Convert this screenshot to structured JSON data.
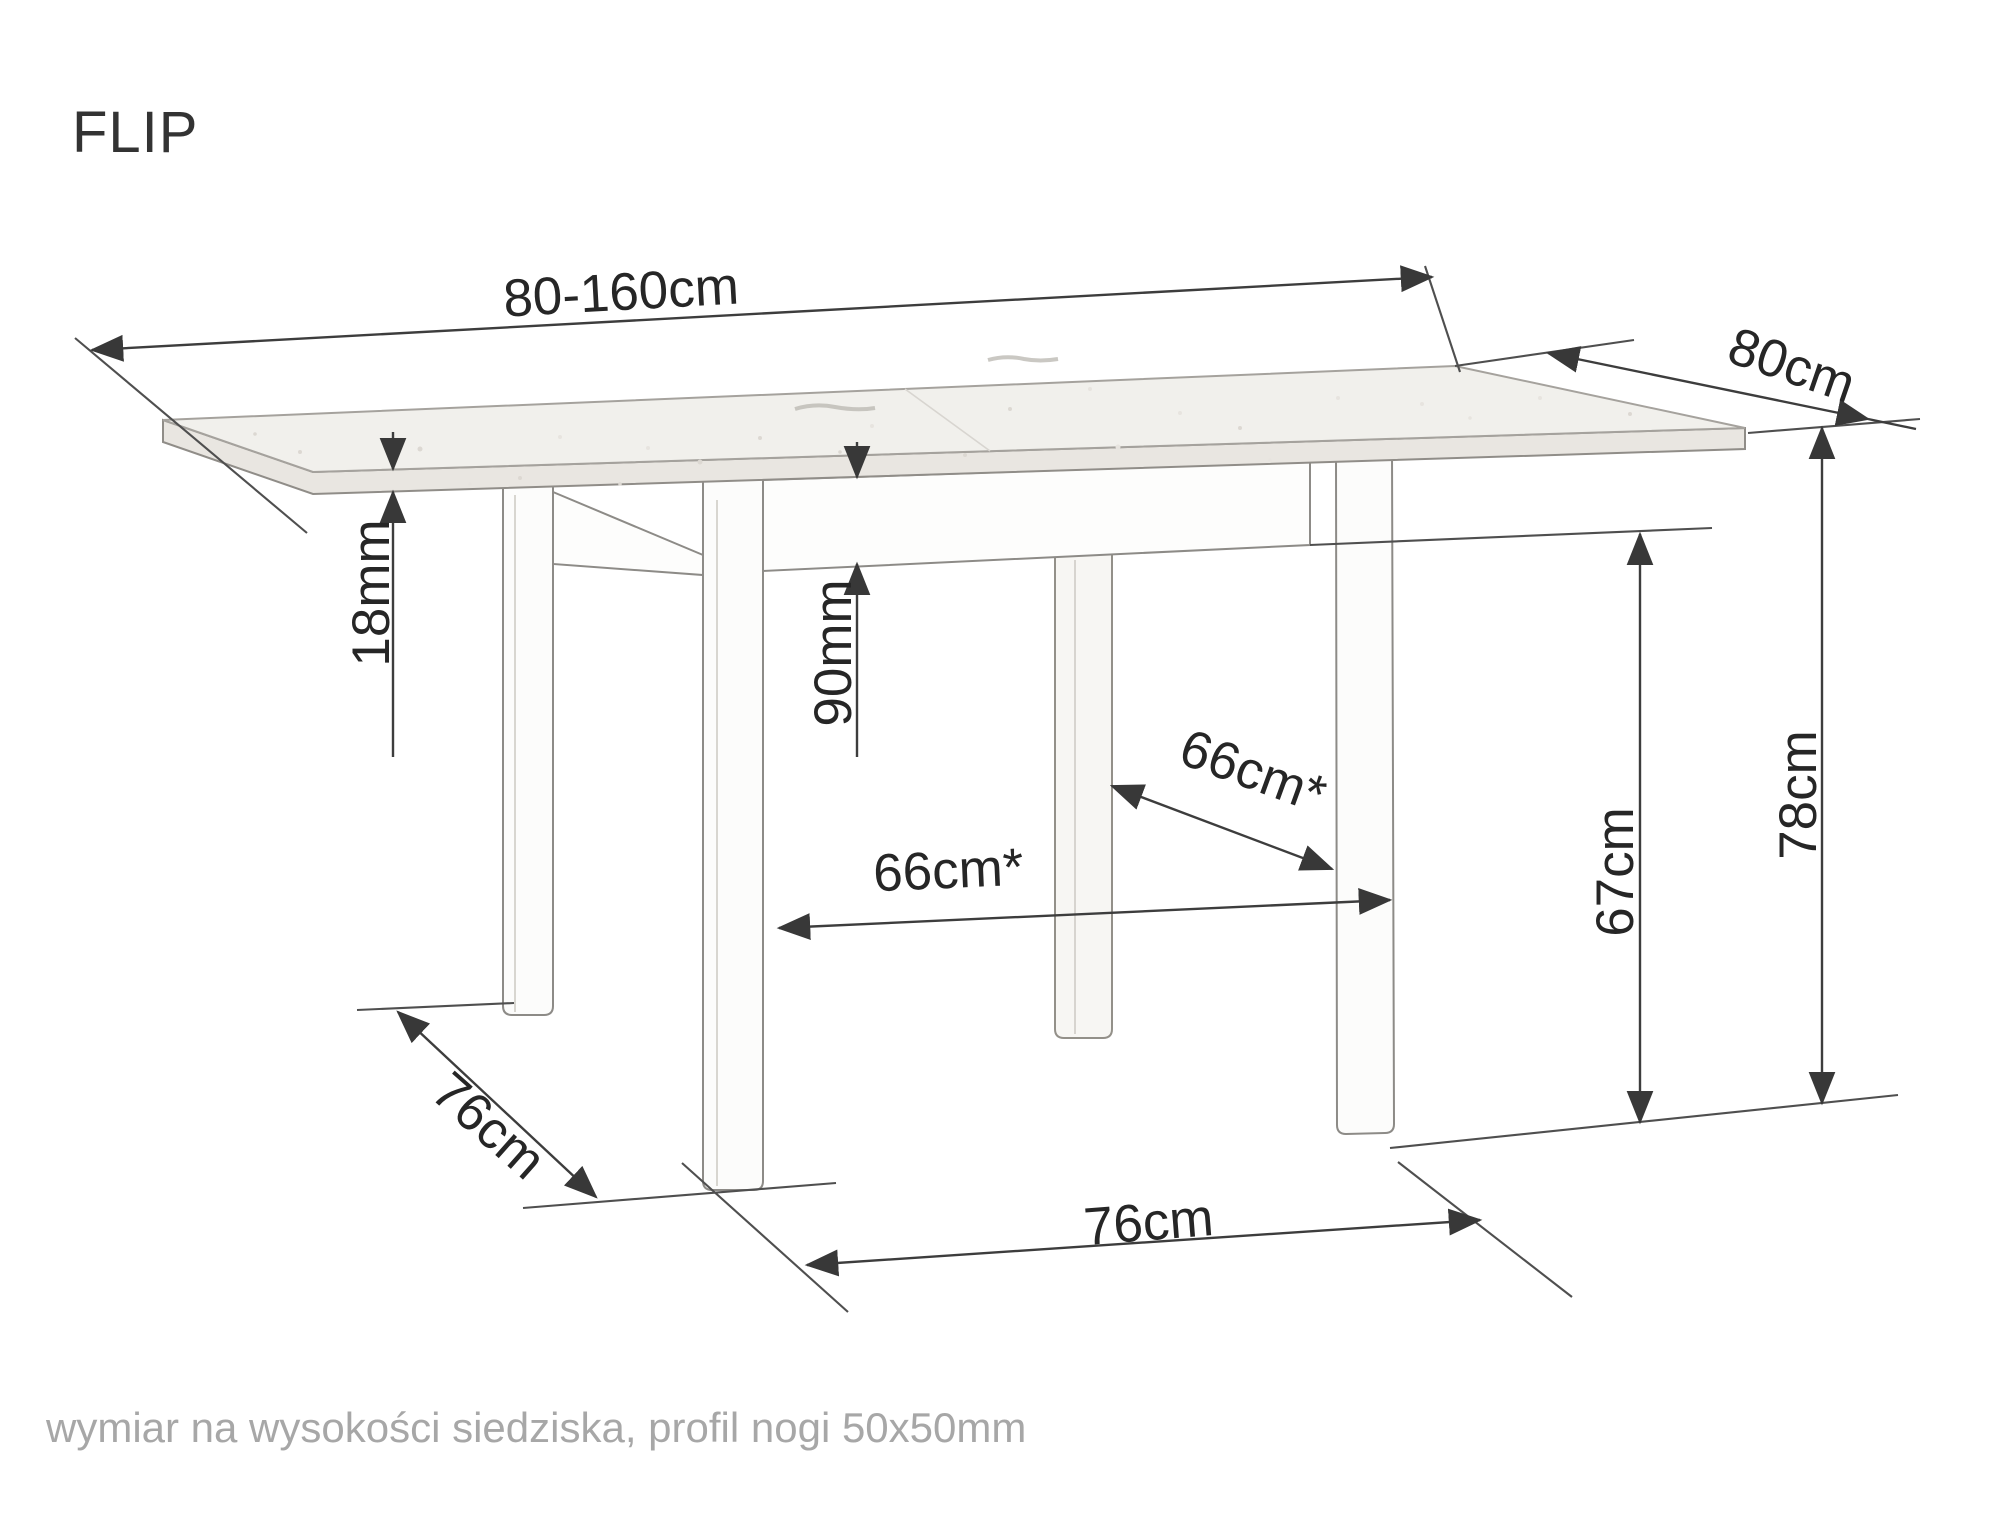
{
  "title": "FLIP",
  "footnote": "wymiar na wysokości siedziska, profil nogi 50x50mm",
  "dimensions": {
    "length": "80-160cm",
    "depth": "80cm",
    "top_thickness": "18mm",
    "apron_height": "90mm",
    "inner_span_rear": "66cm*",
    "inner_span_front": "66cm*",
    "clearance_height": "67cm",
    "total_height": "78cm",
    "foot_span_depth": "76cm",
    "foot_span_length": "76cm"
  },
  "colors": {
    "background": "#ffffff",
    "dimension_line": "#3d3d3d",
    "dimension_text": "#262626",
    "table_edge": "#9d9a95",
    "table_top_fill": "#f1f0ec",
    "table_band_fill": "#e9e6e1",
    "footnote_text": "#a7a7a7"
  }
}
